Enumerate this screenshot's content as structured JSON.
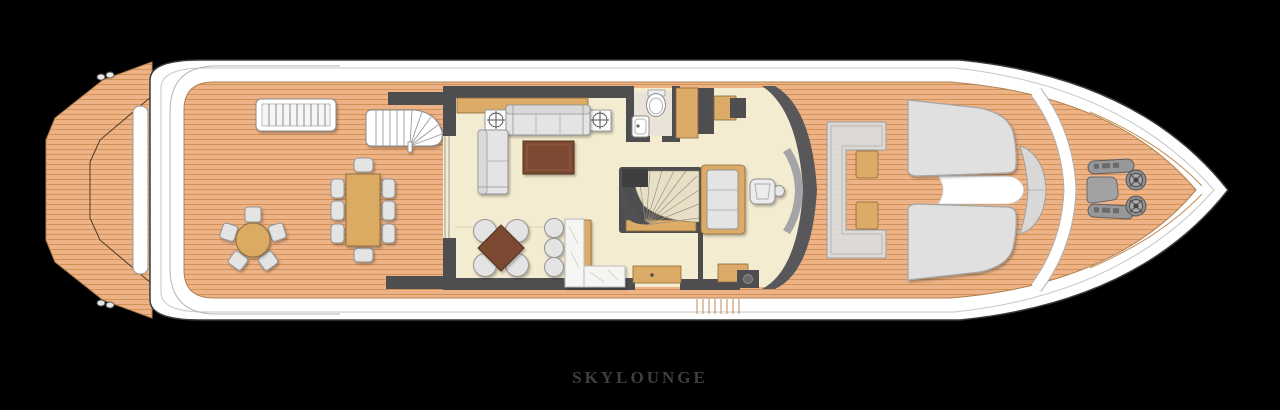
{
  "deck_plan": {
    "title": "SKYLOUNGE",
    "title_color": "#3e3e43",
    "colors": {
      "background": "#000000",
      "hull_white": "#ffffff",
      "hull_outline": "#3a3a3a",
      "teak_deck": "#edb286",
      "teak_plank_line": "#d09257",
      "interior_floor": "#f4ecd0",
      "bathroom_floor": "#e9e4d7",
      "walls": "#4e4e50",
      "wood_cabinet": "#dcab67",
      "upholstery_gray": "#e4e4e4",
      "table_brown": "#7b4a31",
      "dining_table_wood": "#dcab64",
      "marble_bar": "#f5f5f3",
      "sunpad_gray": "#e0e0e0",
      "windshield_gray": "#58585b",
      "winch_gray": "#98989b"
    }
  }
}
